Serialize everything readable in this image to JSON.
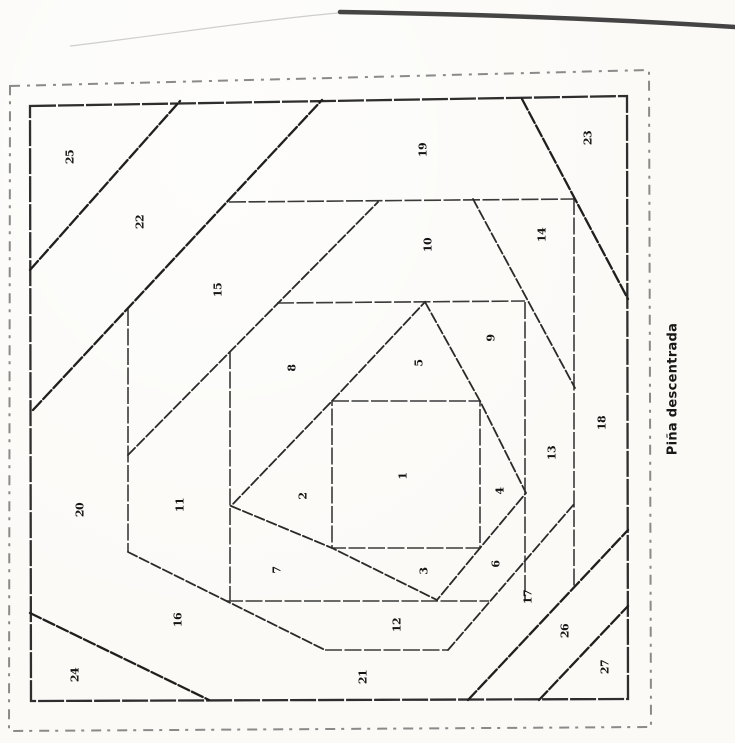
{
  "caption": "Piña descentrada",
  "colors": {
    "ink": "#1f1f1f",
    "seam": "#3a3a3a",
    "border_dash": "#8a8a8a",
    "paper": "#fbfaf7"
  },
  "pattern": {
    "type": "foundation-paper-piecing-block",
    "piece_count": 27
  },
  "pieces": [
    {
      "n": "1",
      "x": 403,
      "y": 476
    },
    {
      "n": "2",
      "x": 303,
      "y": 496
    },
    {
      "n": "3",
      "x": 424,
      "y": 571
    },
    {
      "n": "4",
      "x": 500,
      "y": 491
    },
    {
      "n": "5",
      "x": 419,
      "y": 363
    },
    {
      "n": "6",
      "x": 496,
      "y": 564
    },
    {
      "n": "7",
      "x": 277,
      "y": 570
    },
    {
      "n": "8",
      "x": 292,
      "y": 368
    },
    {
      "n": "9",
      "x": 491,
      "y": 338
    },
    {
      "n": "10",
      "x": 428,
      "y": 245
    },
    {
      "n": "11",
      "x": 180,
      "y": 505
    },
    {
      "n": "12",
      "x": 397,
      "y": 625
    },
    {
      "n": "13",
      "x": 552,
      "y": 453
    },
    {
      "n": "14",
      "x": 542,
      "y": 235
    },
    {
      "n": "15",
      "x": 218,
      "y": 290
    },
    {
      "n": "16",
      "x": 178,
      "y": 620
    },
    {
      "n": "17",
      "x": 528,
      "y": 597
    },
    {
      "n": "18",
      "x": 602,
      "y": 423
    },
    {
      "n": "19",
      "x": 423,
      "y": 150
    },
    {
      "n": "20",
      "x": 80,
      "y": 510
    },
    {
      "n": "21",
      "x": 363,
      "y": 677
    },
    {
      "n": "22",
      "x": 140,
      "y": 222
    },
    {
      "n": "23",
      "x": 588,
      "y": 138
    },
    {
      "n": "24",
      "x": 75,
      "y": 675
    },
    {
      "n": "25",
      "x": 70,
      "y": 157
    },
    {
      "n": "26",
      "x": 565,
      "y": 631
    },
    {
      "n": "27",
      "x": 605,
      "y": 667
    }
  ]
}
